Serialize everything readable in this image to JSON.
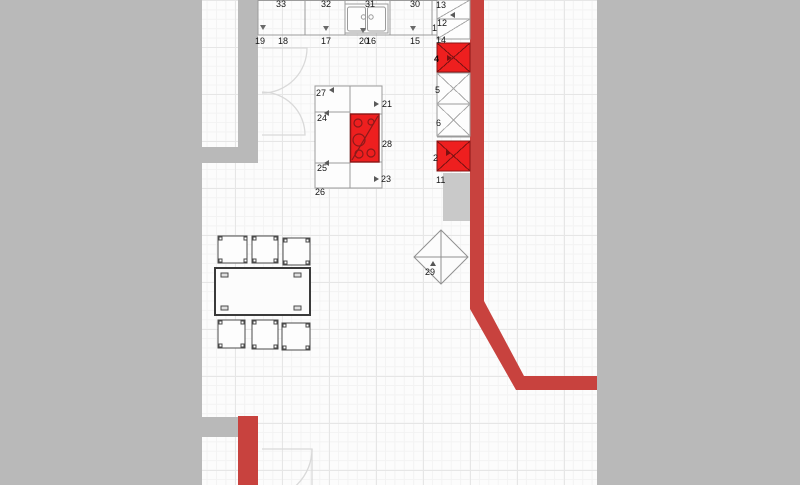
{
  "app": {
    "view": "kitchen-floor-plan"
  },
  "colors": {
    "wall_red": "#c8423e",
    "appliance_red": "#ee1f1f",
    "appliance_border": "#8b1616",
    "mask_gray": "#b9b9b9",
    "strip_gray": "#c9c9c9",
    "cabinet_line_gray": "#9b9b9b",
    "floor_bg": "#fcfcfc"
  },
  "labels": {
    "u33": "33",
    "u32": "32",
    "u31": "31",
    "u30": "30",
    "r13": "13",
    "r12": "12",
    "n1": "1",
    "n14": "14",
    "n4": "4",
    "n5": "5",
    "n6": "6",
    "n2": "2",
    "n11": "11",
    "b19": "19",
    "b18": "18",
    "b17": "17",
    "b20": "20",
    "b16": "16",
    "b15": "15",
    "i27": "27",
    "i24": "24",
    "i25": "25",
    "i26": "26",
    "i21": "21",
    "i28": "28",
    "i23": "23",
    "d29": "29"
  },
  "icons": [
    "leader-arrow-down",
    "leader-arrow-up",
    "leader-arrow-left",
    "leader-arrow-right"
  ],
  "objects": [
    "wall-cabinets-30-33",
    "base-cabinets-14-20",
    "sink-unit",
    "appliance-column-1-13",
    "oven-appliance-red-top",
    "oven-appliance-red-bottom",
    "kitchen-island-21-28",
    "cooktop",
    "dining-table",
    "chairs",
    "diamond-object-29",
    "double-door-left",
    "door-bottom",
    "red-walls"
  ]
}
